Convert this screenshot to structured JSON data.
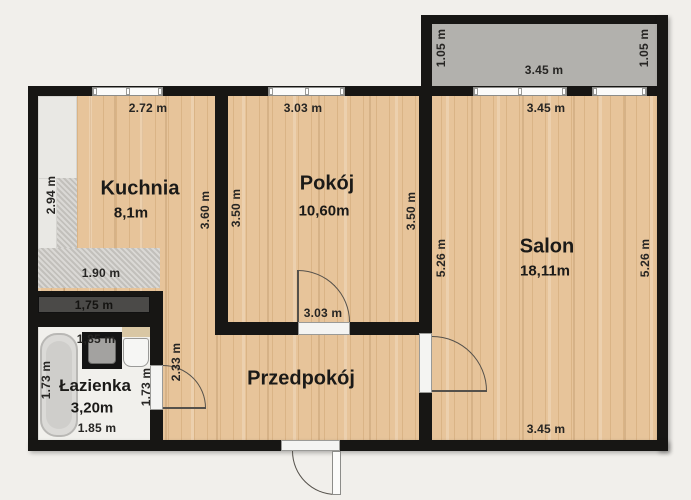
{
  "plan": {
    "title": "apartment-floor-plan",
    "rooms": {
      "kuchnia": {
        "name": "Kuchnia",
        "area": "8,1m"
      },
      "pokoj": {
        "name": "Pokój",
        "area": "10,60m"
      },
      "salon": {
        "name": "Salon",
        "area": "18,11m"
      },
      "lazienka": {
        "name": "Łazienka",
        "area": "3,20m"
      },
      "przedpokoj": {
        "name": "Przedpokój"
      }
    },
    "dimensions": {
      "kitchen_top": "2.72 m",
      "kitchen_left": "2.94 m",
      "kitchen_counter": "1.90 m",
      "kitchen_right": "3.60 m",
      "pokoj_top": "3.03 m",
      "pokoj_left": "3.50 m",
      "pokoj_right": "3.50 m",
      "pokoj_door": "3.03 m",
      "balcony_width": "3.45 m",
      "balcony_side_left": "1.05 m",
      "balcony_side_right": "1.05 m",
      "salon_top": "3.45 m",
      "salon_bottom": "3.45 m",
      "salon_left": "5.26 m",
      "salon_right": "5.26 m",
      "wardrobe": "1,75 m",
      "bath_top": "1,85 m",
      "bath_bottom": "1.85 m",
      "bath_left": "1.73 m",
      "bath_right": "1.73 m",
      "hall_door": "2.33 m"
    },
    "colors": {
      "wall": "#171614",
      "floor_wood": "#e7c49a",
      "balcony": "#b2b1ad",
      "background": "#f1efeb",
      "counter": "#cac8c3",
      "bath_floor": "#f1f0ec"
    }
  }
}
